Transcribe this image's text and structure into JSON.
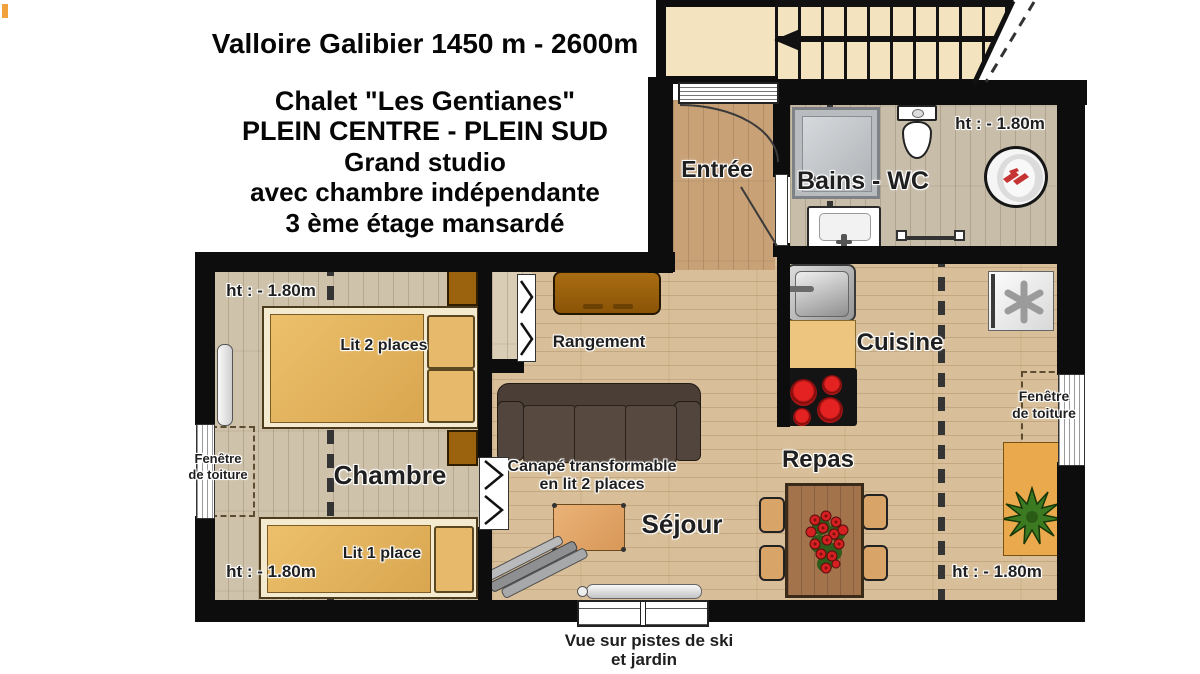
{
  "header": {
    "line1": "Valloire Galibier 1450 m - 2600m",
    "line2": "Chalet \"Les Gentianes\"",
    "line3": "PLEIN CENTRE - PLEIN SUD",
    "line4": "Grand studio",
    "line5": "avec chambre indépendante",
    "line6": "3 ème étage  mansardé"
  },
  "rooms": {
    "entree": "Entrée",
    "bains_wc": "Bains - WC",
    "cuisine": "Cuisine",
    "repas": "Repas",
    "sejour": "Séjour",
    "chambre": "Chambre",
    "rangement": "Rangement"
  },
  "labels": {
    "height_limit": "ht : - 1.80m",
    "bed_double": "Lit 2 places",
    "bed_single": "Lit 1 place",
    "sofa_line1": "Canapé transformable",
    "sofa_line2": "en lit 2 places",
    "roof_window_line1": "Fenêtre",
    "roof_window_line2": "de toiture",
    "view_line1": "Vue sur pistes de ski",
    "view_line2": "et jardin"
  },
  "colors": {
    "wall": "#0d0d0d",
    "stairs_cream": "#f3e3bf",
    "floor_living": "#d8bf99",
    "floor_bedroom": "#cec2ab",
    "floor_bath": "#c8bda9",
    "floor_entry": "#c8a177",
    "wood_furniture_brown": "#9b630d",
    "sofa_dark": "#4a3e37",
    "hob_red": "#d02020",
    "console_orange": "#eba94d",
    "plant_green": "#3c7a22"
  }
}
